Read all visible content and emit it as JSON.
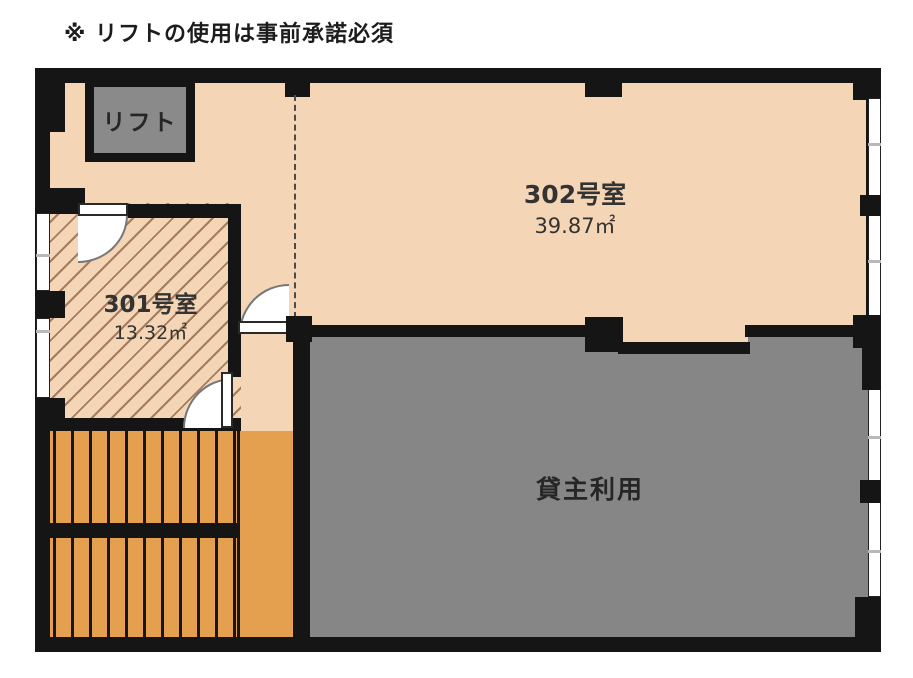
{
  "note": {
    "text": "※ リフトの使用は事前承諾必須"
  },
  "lift": {
    "label": "リフト"
  },
  "room302": {
    "name": "302号室",
    "area": "39.87㎡"
  },
  "room301": {
    "name": "301号室",
    "area": "13.32㎡"
  },
  "landlord": {
    "label": "貸主利用"
  },
  "colors": {
    "floor": "#f4d5b5",
    "stairs": "#e4a04f",
    "gray_area": "#868686",
    "wall": "#151515"
  }
}
